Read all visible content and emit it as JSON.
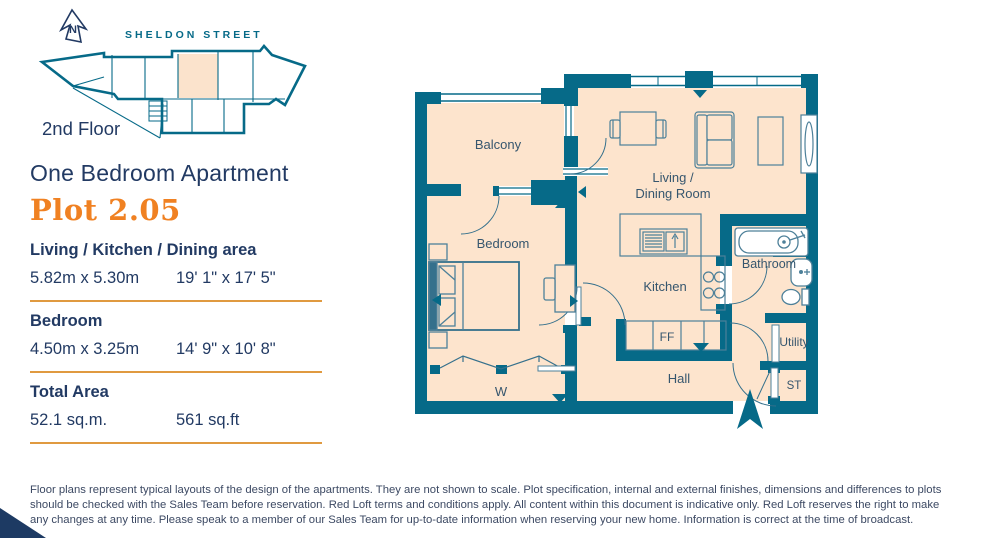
{
  "colors": {
    "wall": "#066a88",
    "furniture_line": "#4d8099",
    "room_fill": "#fde4cd",
    "navy": "#223a63",
    "label": "#36566e",
    "plot_orange": "#f08122",
    "divider_orange": "#e09a40",
    "wedge_navy": "#1d3a63"
  },
  "site_plan": {
    "north_label": "N",
    "street": "SHELDON STREET",
    "floor": "2nd Floor"
  },
  "info": {
    "title": "One Bedroom Apartment",
    "plot": "Plot 2.05",
    "sections": [
      {
        "name": "Living / Kitchen / Dining area",
        "metric": "5.82m x 5.30m",
        "imperial": "19' 1\" x 17' 5\""
      },
      {
        "name": "Bedroom",
        "metric": "4.50m x 3.25m",
        "imperial": "14' 9\" x 10' 8\""
      },
      {
        "name": "Total Area",
        "metric": "52.1 sq.m.",
        "imperial": "561 sq.ft"
      }
    ]
  },
  "floor_plan": {
    "rooms": {
      "balcony": "Balcony",
      "living_line1": "Living /",
      "living_line2": "Dining Room",
      "bedroom": "Bedroom",
      "kitchen": "Kitchen",
      "bathroom": "Bathroom",
      "hall": "Hall",
      "utility": "Utility",
      "store": "ST",
      "wardrobe": "W",
      "fridge_freezer": "FF"
    }
  },
  "disclaimer": "Floor plans represent typical layouts of the design of the apartments. They are not shown to scale. Plot specification, internal and external finishes, dimensions and differences to plots should be checked with the Sales Team before reservation. Red Loft terms and conditions apply. All content within this document is indicative only. Red Loft reserves the right to make any changes at any time. Please speak to a member of our Sales Team for up-to-date information when reserving your new home. Information is correct at the time of broadcast."
}
